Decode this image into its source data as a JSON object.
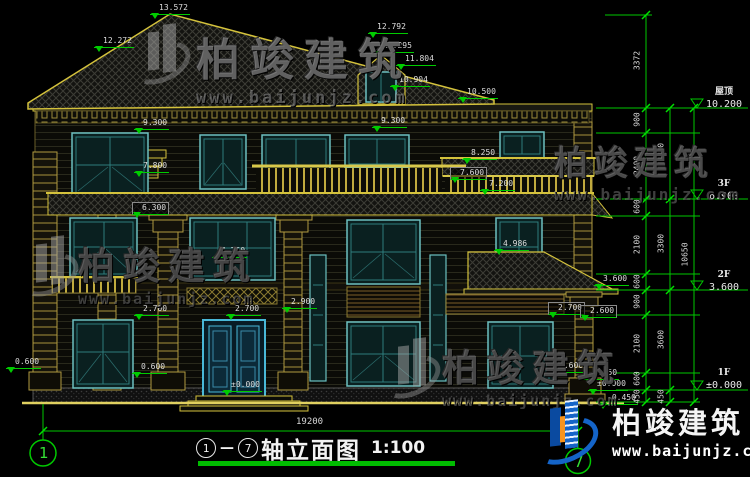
{
  "title": {
    "axis_from": "1",
    "dash": "—",
    "axis_to": "7",
    "name": "轴立面图",
    "scale": "1:100"
  },
  "axes": {
    "left": "1",
    "right": "7"
  },
  "bottom": {
    "overall": "19200"
  },
  "watermark": {
    "brand": "柏竣建筑",
    "url": "www.baijunjz.com"
  },
  "levels": [
    {
      "n": "屋顶",
      "v": "10.200"
    },
    {
      "n": "3F",
      "v": "6.900"
    },
    {
      "n": "2F",
      "v": "3.600"
    },
    {
      "n": "1F",
      "v": "±0.000"
    }
  ],
  "chains": {
    "inner": [
      "3372",
      "900",
      "2400",
      "600",
      "2100",
      "600",
      "900",
      "2100",
      "600",
      "450"
    ],
    "mid": [
      "3300",
      "3300",
      "3600",
      "450"
    ],
    "outer": [
      "10650"
    ]
  },
  "marks": [
    {
      "t": "13.572"
    },
    {
      "t": "12.272"
    },
    {
      "t": "12.792"
    },
    {
      "t": "12.295"
    },
    {
      "t": "11.804"
    },
    {
      "t": "10.904"
    },
    {
      "t": "10.500"
    },
    {
      "t": "9.300"
    },
    {
      "t": "9.300"
    },
    {
      "t": "7.800"
    },
    {
      "t": "8.250"
    },
    {
      "t": "7.600"
    },
    {
      "t": "7.200"
    },
    {
      "t": "6.300"
    },
    {
      "t": "4.986"
    },
    {
      "t": "4.750"
    },
    {
      "t": "3.600"
    },
    {
      "t": "2.900"
    },
    {
      "t": "2.700"
    },
    {
      "t": "2.700"
    },
    {
      "t": "2.700"
    },
    {
      "t": "2.600"
    },
    {
      "t": "0.600"
    },
    {
      "t": "0.600"
    },
    {
      "t": "0.600"
    },
    {
      "t": "0.450"
    },
    {
      "t": "±0.000"
    },
    {
      "t": "±0.000"
    },
    {
      "t": "-0.450"
    }
  ],
  "colors": {
    "dim_green": "#00cc00",
    "trim_yellow": "#d4c23c",
    "window_teal": "#6cc0c0",
    "door_cyan": "#49b8d8",
    "logo_blue": "#1464c8",
    "logo_orange": "#f7941d"
  }
}
